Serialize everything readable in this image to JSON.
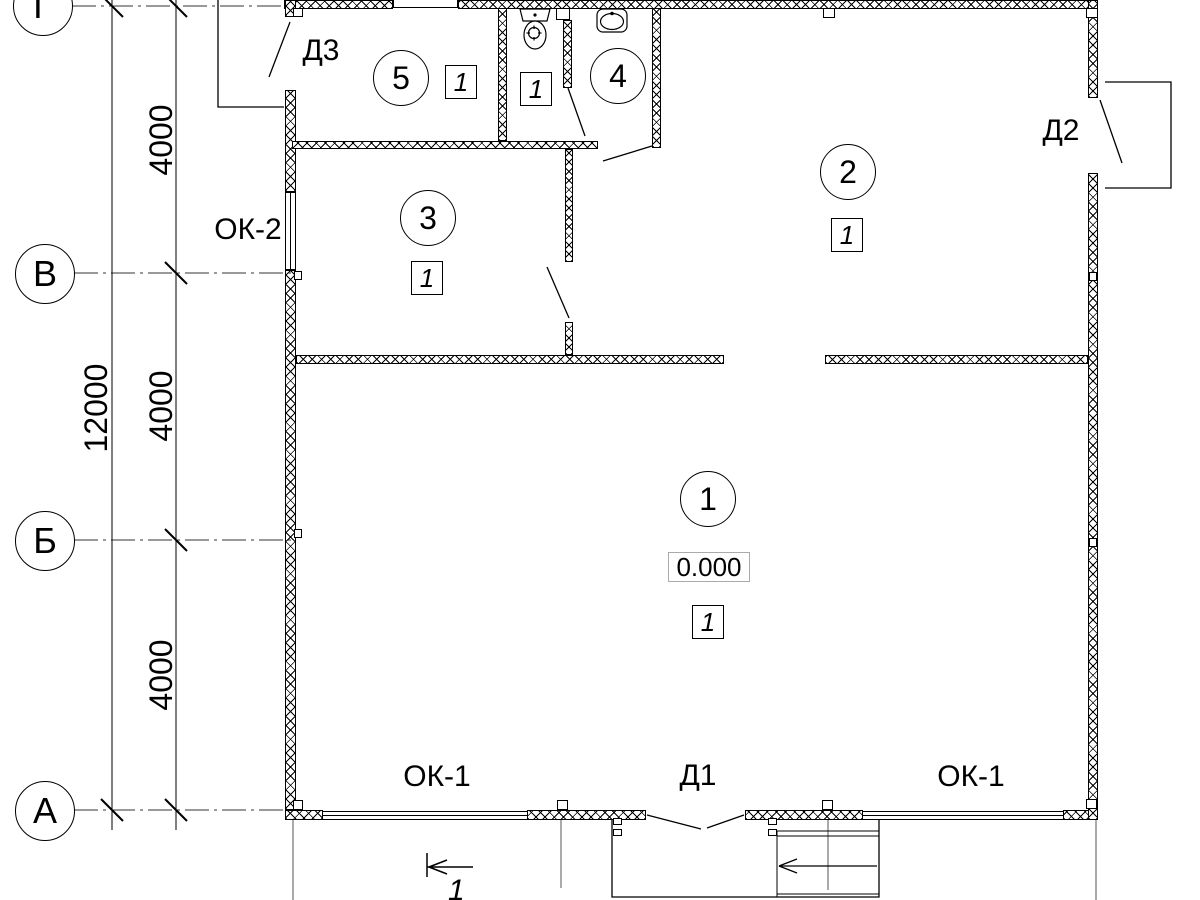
{
  "meta": {
    "drawing_type": "architectural floor plan",
    "colors": {
      "line": "#000000",
      "background": "#ffffff",
      "axis_line": "#333333"
    }
  },
  "axes": {
    "g": "Г",
    "v": "В",
    "b": "Б",
    "a": "А"
  },
  "dims": {
    "overall": "12000",
    "seg_top": "4000",
    "seg_mid": "4000",
    "seg_bot": "4000"
  },
  "rooms": {
    "r1": {
      "num": "1",
      "cat": "1",
      "elev": "0.000"
    },
    "r2": {
      "num": "2",
      "cat": "1"
    },
    "r3": {
      "num": "3",
      "cat": "1"
    },
    "r4": {
      "num": "4"
    },
    "r5": {
      "num": "5",
      "cat": "1"
    },
    "wc": {
      "cat": "1"
    }
  },
  "openings": {
    "d1": "Д1",
    "d2": "Д2",
    "d3": "Д3",
    "ok1_left": "ОК-1",
    "ok1_right": "ОК-1",
    "ok2": "ОК-2"
  },
  "section": {
    "mark": "1"
  },
  "icons": {
    "toilet": "toilet-icon",
    "sink": "sink-icon",
    "stairs": "entrance-stairs"
  }
}
